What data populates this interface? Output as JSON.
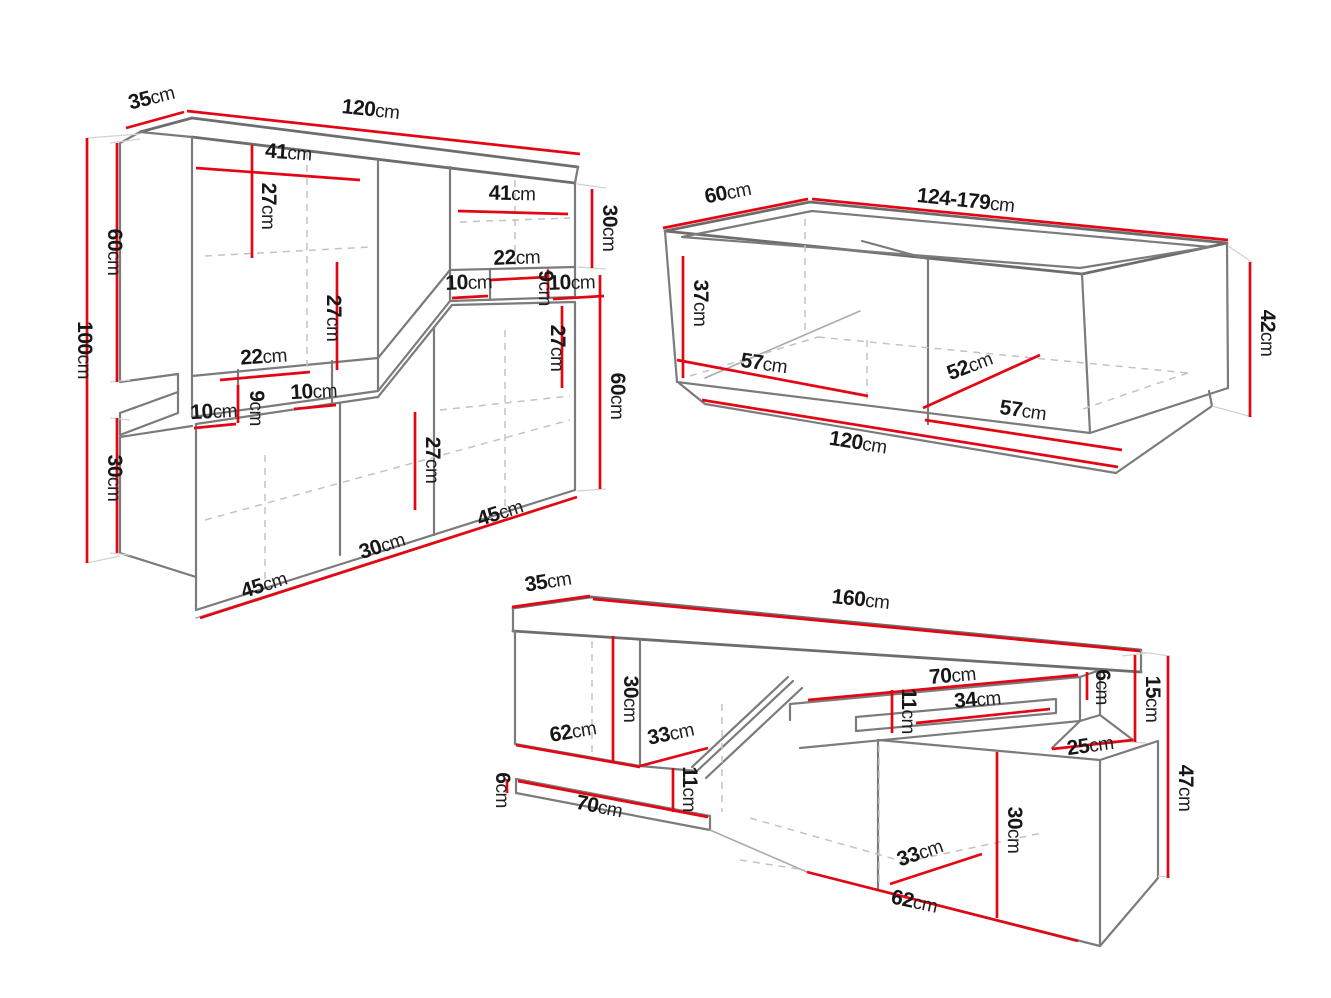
{
  "colors": {
    "dimension_line": "#e30613",
    "outline": "#7b7b7b",
    "dashed_line": "#c3c3c3",
    "label_text": "#171717",
    "background": "#ffffff"
  },
  "diagrams": {
    "wall_unit": {
      "name": "wall-unit-dimension-drawing",
      "dims": {
        "depth": {
          "value": "35",
          "unit": "cm"
        },
        "width": {
          "value": "120",
          "unit": "cm"
        },
        "shelf_a_w": {
          "value": "41",
          "unit": "cm"
        },
        "shelf_a_h": {
          "value": "27",
          "unit": "cm"
        },
        "shelf_b_w": {
          "value": "41",
          "unit": "cm"
        },
        "right_top_h": {
          "value": "30",
          "unit": "cm"
        },
        "niche_top_w": {
          "value": "22",
          "unit": "cm"
        },
        "niche_top_left_w": {
          "value": "10",
          "unit": "cm"
        },
        "niche_top_h": {
          "value": "9",
          "unit": "cm"
        },
        "niche_top_right_w": {
          "value": "10",
          "unit": "cm"
        },
        "shelf_c_h": {
          "value": "27",
          "unit": "cm"
        },
        "shelf_d_h": {
          "value": "27",
          "unit": "cm"
        },
        "left_top_h": {
          "value": "60",
          "unit": "cm"
        },
        "height": {
          "value": "100",
          "unit": "cm"
        },
        "niche_bottom_w": {
          "value": "22",
          "unit": "cm"
        },
        "niche_bottom_h": {
          "value": "9",
          "unit": "cm"
        },
        "niche_bottom_left_w": {
          "value": "10",
          "unit": "cm"
        },
        "niche_bottom_right_w": {
          "value": "10",
          "unit": "cm"
        },
        "left_bottom_h": {
          "value": "30",
          "unit": "cm"
        },
        "shelf_e_h": {
          "value": "27",
          "unit": "cm"
        },
        "right_bottom_h": {
          "value": "60",
          "unit": "cm"
        },
        "base_right_w": {
          "value": "45",
          "unit": "cm"
        },
        "base_middle_w": {
          "value": "30",
          "unit": "cm"
        },
        "base_left_w": {
          "value": "45",
          "unit": "cm"
        }
      }
    },
    "coffee_table": {
      "name": "coffee-table-dimension-drawing",
      "dims": {
        "depth": {
          "value": "60",
          "unit": "cm"
        },
        "width": {
          "value": "124-179",
          "unit": "cm"
        },
        "inner_height": {
          "value": "37",
          "unit": "cm"
        },
        "height": {
          "value": "42",
          "unit": "cm"
        },
        "floor_depth_left": {
          "value": "57",
          "unit": "cm"
        },
        "floor_width": {
          "value": "52",
          "unit": "cm"
        },
        "floor_depth_right": {
          "value": "57",
          "unit": "cm"
        },
        "base_width": {
          "value": "120",
          "unit": "cm"
        }
      }
    },
    "tv_stand": {
      "name": "tv-stand-dimension-drawing",
      "dims": {
        "depth": {
          "value": "35",
          "unit": "cm"
        },
        "width": {
          "value": "160",
          "unit": "cm"
        },
        "left_inner_height": {
          "value": "30",
          "unit": "cm"
        },
        "left_width": {
          "value": "62",
          "unit": "cm"
        },
        "left_depth": {
          "value": "33",
          "unit": "cm"
        },
        "left_niche_height": {
          "value": "11",
          "unit": "cm"
        },
        "shelf_left_height": {
          "value": "6",
          "unit": "cm"
        },
        "shelf_left_width": {
          "value": "70",
          "unit": "cm"
        },
        "shelf_right_width": {
          "value": "70",
          "unit": "cm"
        },
        "slot_height": {
          "value": "11",
          "unit": "cm"
        },
        "slot_width": {
          "value": "34",
          "unit": "cm"
        },
        "shelf_right_height": {
          "value": "6",
          "unit": "cm"
        },
        "right_end_height": {
          "value": "15",
          "unit": "cm"
        },
        "right_end_depth": {
          "value": "25",
          "unit": "cm"
        },
        "height": {
          "value": "47",
          "unit": "cm"
        },
        "right_inner_height": {
          "value": "30",
          "unit": "cm"
        },
        "right_depth": {
          "value": "33",
          "unit": "cm"
        },
        "right_width": {
          "value": "62",
          "unit": "cm"
        }
      }
    }
  }
}
